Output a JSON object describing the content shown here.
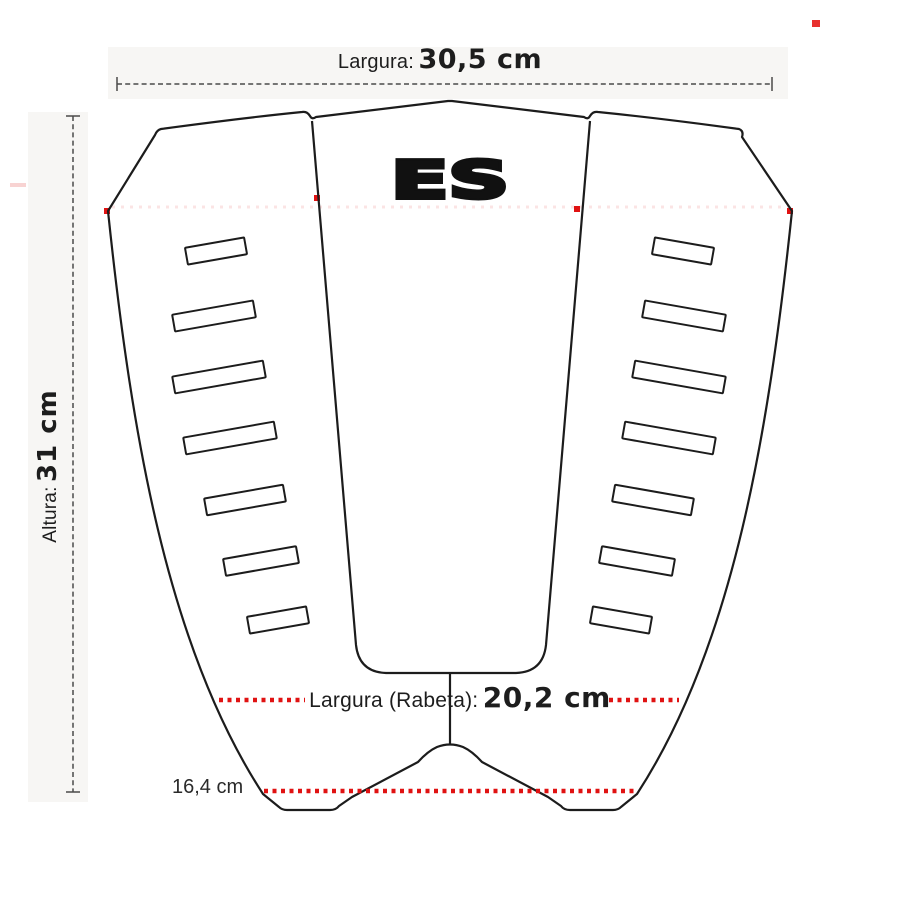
{
  "diagram": {
    "title_hint": "surf traction pad dimension diagram",
    "logo": {
      "text": "ES",
      "color": "#111111"
    },
    "dimensions": {
      "width": {
        "label": "Largura:",
        "value": "30,5 cm"
      },
      "height": {
        "label": "Altura:",
        "value": "31 cm"
      },
      "tail_width": {
        "label": "Largura (Rabeta):",
        "value": "20,2 cm"
      },
      "kick_width": {
        "value": "16,4 cm"
      }
    },
    "colors": {
      "outline": "#1c1c1c",
      "dimension_line": "#4a4a4a",
      "highlight_red": "#e01212",
      "band": "#f7f6f4",
      "background": "#ffffff"
    },
    "panels": {
      "left_slots": 7,
      "right_slots": 7
    }
  }
}
